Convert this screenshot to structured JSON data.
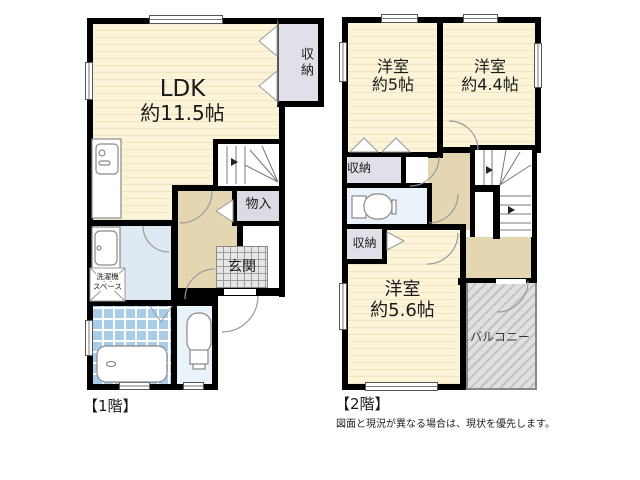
{
  "floor1": {
    "label": "【1階】",
    "ldk": {
      "name": "LDK",
      "size": "約11.5帖"
    },
    "closet": "収納",
    "storage": "物入",
    "entrance": "玄関",
    "laundry_line1": "洗濯機",
    "laundry_line2": "スペース"
  },
  "floor2": {
    "label": "【2階】",
    "room_5": {
      "name": "洋室",
      "size": "約5帖"
    },
    "room_4_4": {
      "name": "洋室",
      "size": "約4.4帖"
    },
    "room_5_6": {
      "name": "洋室",
      "size": "約5.6帖"
    },
    "closet_upper": "収納",
    "closet_lower": "収納",
    "balcony": "バルコニー"
  },
  "note": "図面と現況が異なる場合は、現状を優先します。",
  "colors": {
    "wall": "#000000",
    "room_floor": "#FBF4D9",
    "room_floor_stripe": "#EFE5C0",
    "hallway": "#E5D6B2",
    "closet": "#E2DFE8",
    "water_room": "#DFE9F4",
    "toilet_room": "#EAF2FA",
    "bath_tile": "#A9CDE9",
    "entrance_tile": "#E7E7E7",
    "balcony": "#D9D9D9"
  }
}
